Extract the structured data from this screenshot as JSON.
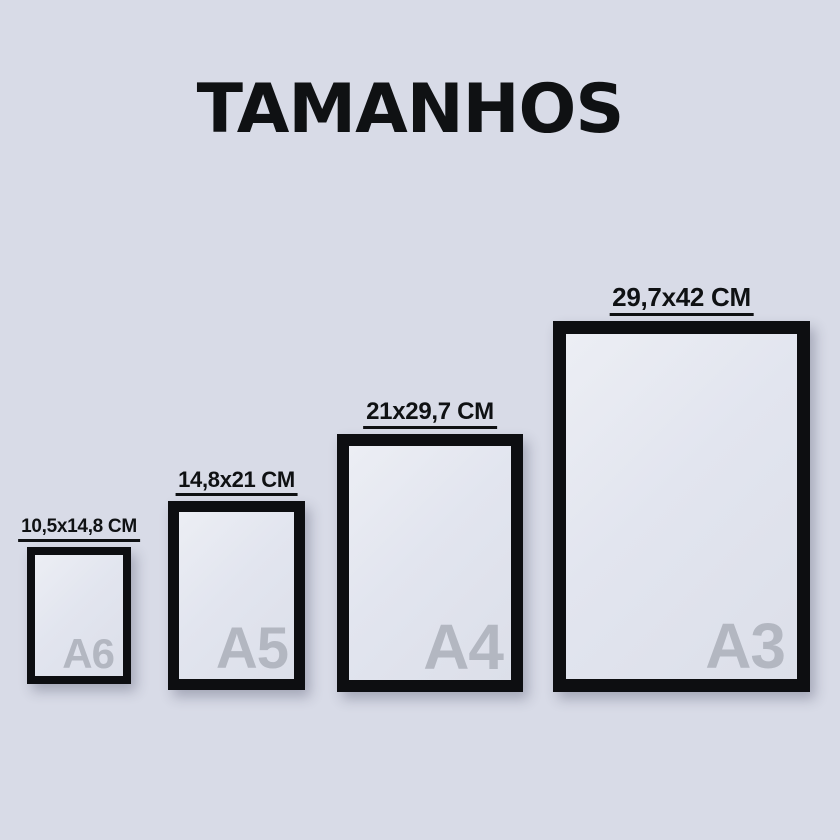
{
  "title": "TAMANHOS",
  "colors": {
    "background": "#d8dbe7",
    "ink": "#0f1113",
    "frame": "#0d0e11",
    "paper": "#e2e5ef",
    "letter": "#b3b7c1"
  },
  "sizes": [
    {
      "name": "A6",
      "dimensions": "10,5x14,8 CM"
    },
    {
      "name": "A5",
      "dimensions": "14,8x21 CM"
    },
    {
      "name": "A4",
      "dimensions": "21x29,7 CM"
    },
    {
      "name": "A3",
      "dimensions": "29,7x42 CM"
    }
  ]
}
